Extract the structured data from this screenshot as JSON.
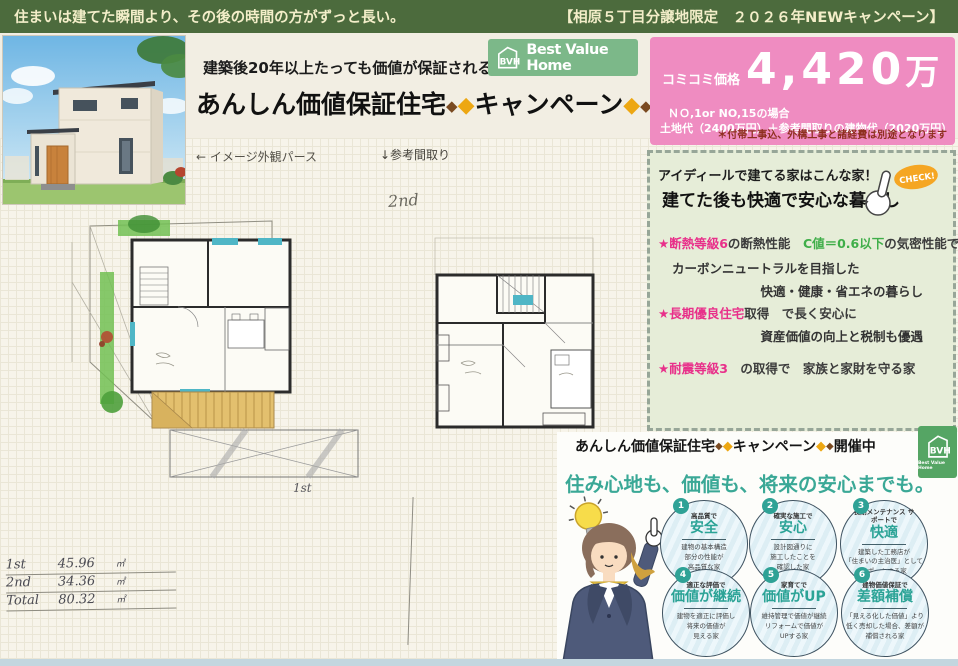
{
  "banner": {
    "left": "住まいは建てた瞬間より、その後の時間の方がずっと長い。",
    "right": "【相原５丁目分譲地限定　２０２６年NEWキャンペーン】"
  },
  "logo": {
    "abbr": "BVH",
    "name": "Best Value Home"
  },
  "header": {
    "catch": "建築後20年以上たっても価値が保証される家！！",
    "title": "あんしん価値保証住宅",
    "title2": "キャンペーン",
    "diamond": "◆"
  },
  "price": {
    "label": "コミコミ価格",
    "value": "4,420",
    "unit": "万",
    "case_line": "ＮＯ,1or NO,15の場合",
    "breakdown": "土地代（2400万円）＋参考間取りの建物代（2020万円）",
    "note": "＊付帯工事込、外構工事と諸経費は別途となります"
  },
  "plan": {
    "exterior_label": "← イメージ外観パース",
    "floor_label": "↓参考間取り",
    "mark_2nd": "2nd",
    "mark_1st": "1st"
  },
  "features": {
    "intro1": "アイディールで建てる家はこんな家！",
    "intro2": "建てた後も快適で安心な暮らし",
    "check": "CHECK!",
    "star": "★",
    "item1": {
      "hl1": "断熱等級6",
      "t1": "の断熱性能",
      "hl2": "　C値＝0.6以下",
      "t2": "の気密性能で",
      "sub1": "カーボンニュートラルを目指した",
      "sub2": "快適・健康・省エネの暮らし"
    },
    "item2": {
      "hl1": "長期優良住宅",
      "t1": "取得　で長く安心に",
      "sub1": "資産価値の向上と税制も優遇"
    },
    "item3": {
      "hl1": "耐震等級3",
      "t1": "　の取得で　家族と家財を守る家"
    }
  },
  "campaign": {
    "heading1": "あんしん価値保証住宅",
    "heading2": "キャンペーン",
    "heading3": "開催中",
    "tagline": "住み心地も、価値も、将来の安心までも。",
    "circles": [
      {
        "num": "1",
        "lead": "高品質で",
        "word": "安全",
        "d1": "建物の基本構造",
        "d2": "部分の性能が",
        "d3": "高品質な家"
      },
      {
        "num": "2",
        "lead": "確実な施工で",
        "word": "安心",
        "d1": "設計図通りに",
        "d2": "施工したことを",
        "d3": "確認した家"
      },
      {
        "num": "3",
        "lead": "長期メンテナンス サポートで",
        "word": "快適",
        "d1": "建築した工務店が",
        "d2": "「住まいの主治医」として",
        "d3": "サポートする家"
      },
      {
        "num": "4",
        "lead": "適正な評価で",
        "word": "価値が継続",
        "d1": "建物を適正に評価し",
        "d2": "将来の価値が",
        "d3": "見える家"
      },
      {
        "num": "5",
        "lead": "家育てで",
        "word": "価値がUP",
        "d1": "維持管理で価値が継続",
        "d2": "リフォームで価値が",
        "d3": "UPする家"
      },
      {
        "num": "6",
        "lead": "建物価値保証で",
        "word": "差額補償",
        "d1": "「見える化した価値」より",
        "d2": "低く売却した場合、差額が",
        "d3": "補償される家"
      }
    ]
  },
  "area_table": {
    "r1n": "1st",
    "r1v": "45.96",
    "r1u": "㎡",
    "r2n": "2nd",
    "r2v": "34.36",
    "r2u": "㎡",
    "r3n": "Total",
    "r3v": "80.32",
    "r3u": "㎡"
  },
  "colors": {
    "banner_green": "#4c6b3d",
    "logo_green": "#7cb889",
    "price_pink": "#ef8cc1",
    "note_red": "#8f2f20",
    "panel_green": "#e6edd8",
    "highlight_magenta": "#e8308a",
    "highlight_green": "#3fae49",
    "teal": "#3aa896",
    "diamond_gold": "#eda712",
    "diamond_brown": "#7a4a21"
  }
}
